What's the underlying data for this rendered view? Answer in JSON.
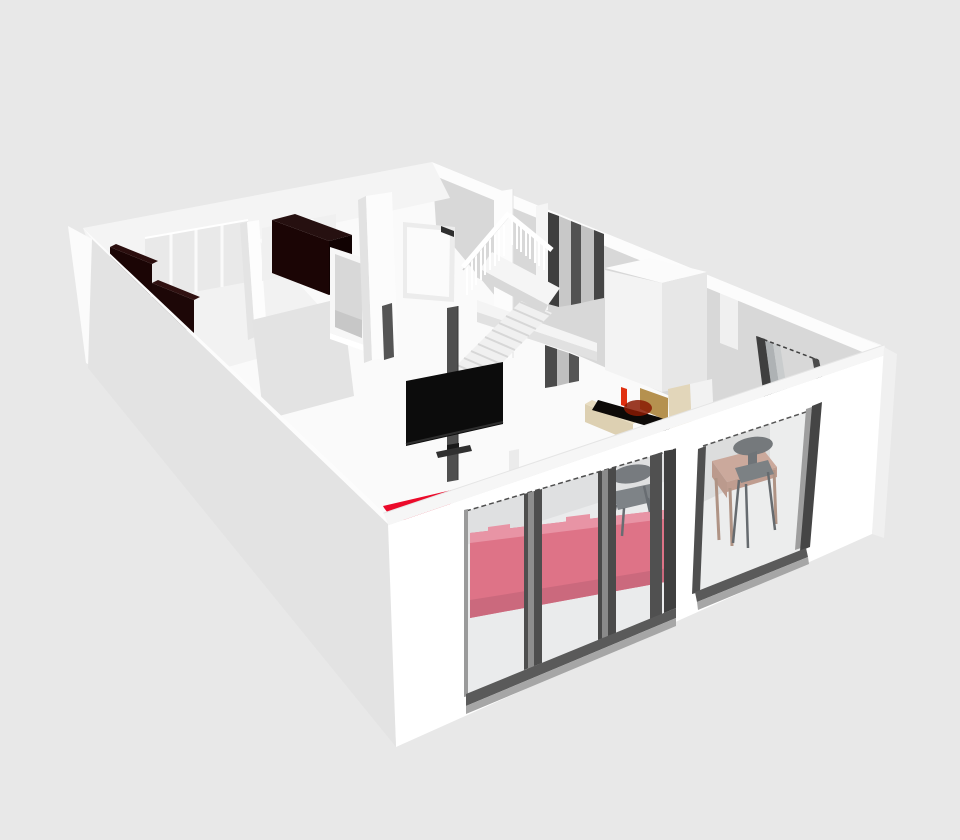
{
  "view": {
    "type": "3d-home-plan-render",
    "description": "Aerial cutaway 3D rendering of a one-storey apartment with living room, kitchen, bedroom, staircase and dining corner",
    "background": "#e8e8e8"
  },
  "palette": {
    "background": "#e8e8e8",
    "floor": "#fafafa",
    "wall_white": "#ffffff",
    "wall_top_band": "#f6f6f6",
    "left_wall_shade": "#e3e3e3",
    "back_right_wall": "#d8d8d8",
    "panel_gray": "#e9e9e9",
    "sofa": "#e0566f",
    "sofa_light": "#ee8095",
    "sofa_dark": "#c84a62",
    "rug_red": "#eb0a2a",
    "tv_black": "#0c0c0c",
    "tv_pole": "#4f4f4f",
    "furniture_dark": "#1b0505",
    "furniture_dark_side": "#110202",
    "furniture_dark_top": "#2b0e0e",
    "frame_dark": "#4e4e4e",
    "frame_mid": "#8e8e8e",
    "sill_dark": "#5a5a5a",
    "sill_light": "#a6a6a6",
    "glass_tint": "#d5dadd",
    "fireplace_cream": "#ddd0b2",
    "fireplace_cream_light": "#e8dcc0",
    "fireplace_tan": "#b5914f",
    "firebox_black": "#0d0a08",
    "fire_red": "#e03010",
    "fire_glow": "#8a1a02",
    "table_wood": "#c99d8d",
    "table_wood_side": "#b58a7a",
    "chair_gray": "#5d6165",
    "chair_gray_dark": "#4a4f54",
    "stair_line": "#d7d7d7",
    "landing": "#f4f4f4"
  },
  "objects": [
    "left-exterior-wall",
    "back-left-wall",
    "back-right-wall",
    "front-glazed-wall",
    "bedroom-wardrobes",
    "kitchen-cabinet",
    "pass-through-window",
    "entry-door",
    "staircase",
    "stair-railing",
    "upper-landing",
    "tall-window",
    "chimney",
    "fireplace",
    "tv-on-pole",
    "half-round-rug",
    "pink-sofa",
    "dining-chairs",
    "dining-table",
    "sliding-glass-door",
    "patio-glass-door"
  ]
}
